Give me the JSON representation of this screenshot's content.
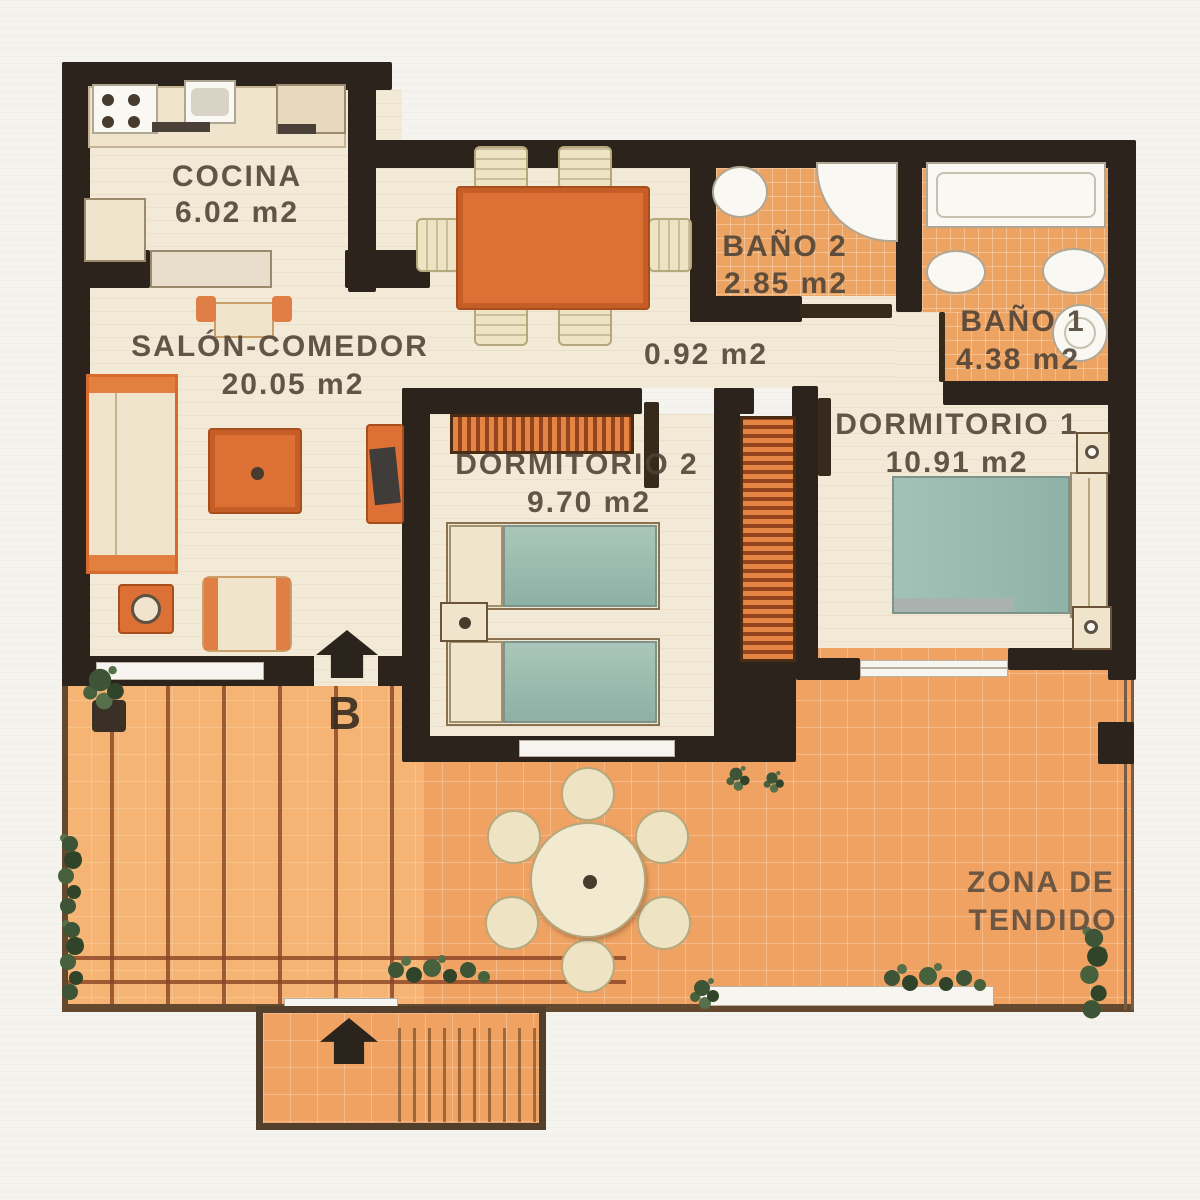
{
  "labels": {
    "cocina_name": "COCINA",
    "cocina_area": "6.02 m2",
    "salon_name": "SALÓN-COMEDOR",
    "salon_area": "20.05 m2",
    "bano2_name": "BAÑO 2",
    "bano2_area": "2.85 m2",
    "hall_area": "0.92 m2",
    "bano1_name": "BAÑO 1",
    "bano1_area": "4.38 m2",
    "dorm2_name": "DORMITORIO 2",
    "dorm2_area": "9.70 m2",
    "dorm1_name": "DORMITORIO 1",
    "dorm1_area": "10.91 m2",
    "zona_line1": "ZONA DE",
    "zona_line2": "TENDIDO",
    "entrance_letter": "B"
  },
  "colors": {
    "wall": "#2c231c",
    "floor_cream": "#f3e9d7",
    "tile_terrace": "#f0a263",
    "tile_bath": "#eda463",
    "furniture_orange": "#dd7034",
    "wardrobe_stripe": "#94451d",
    "bed_teal": "#9fc0b4",
    "cream_furniture": "#f0e5cc",
    "plant_green": "#3d5536",
    "text": "#4d4135"
  }
}
